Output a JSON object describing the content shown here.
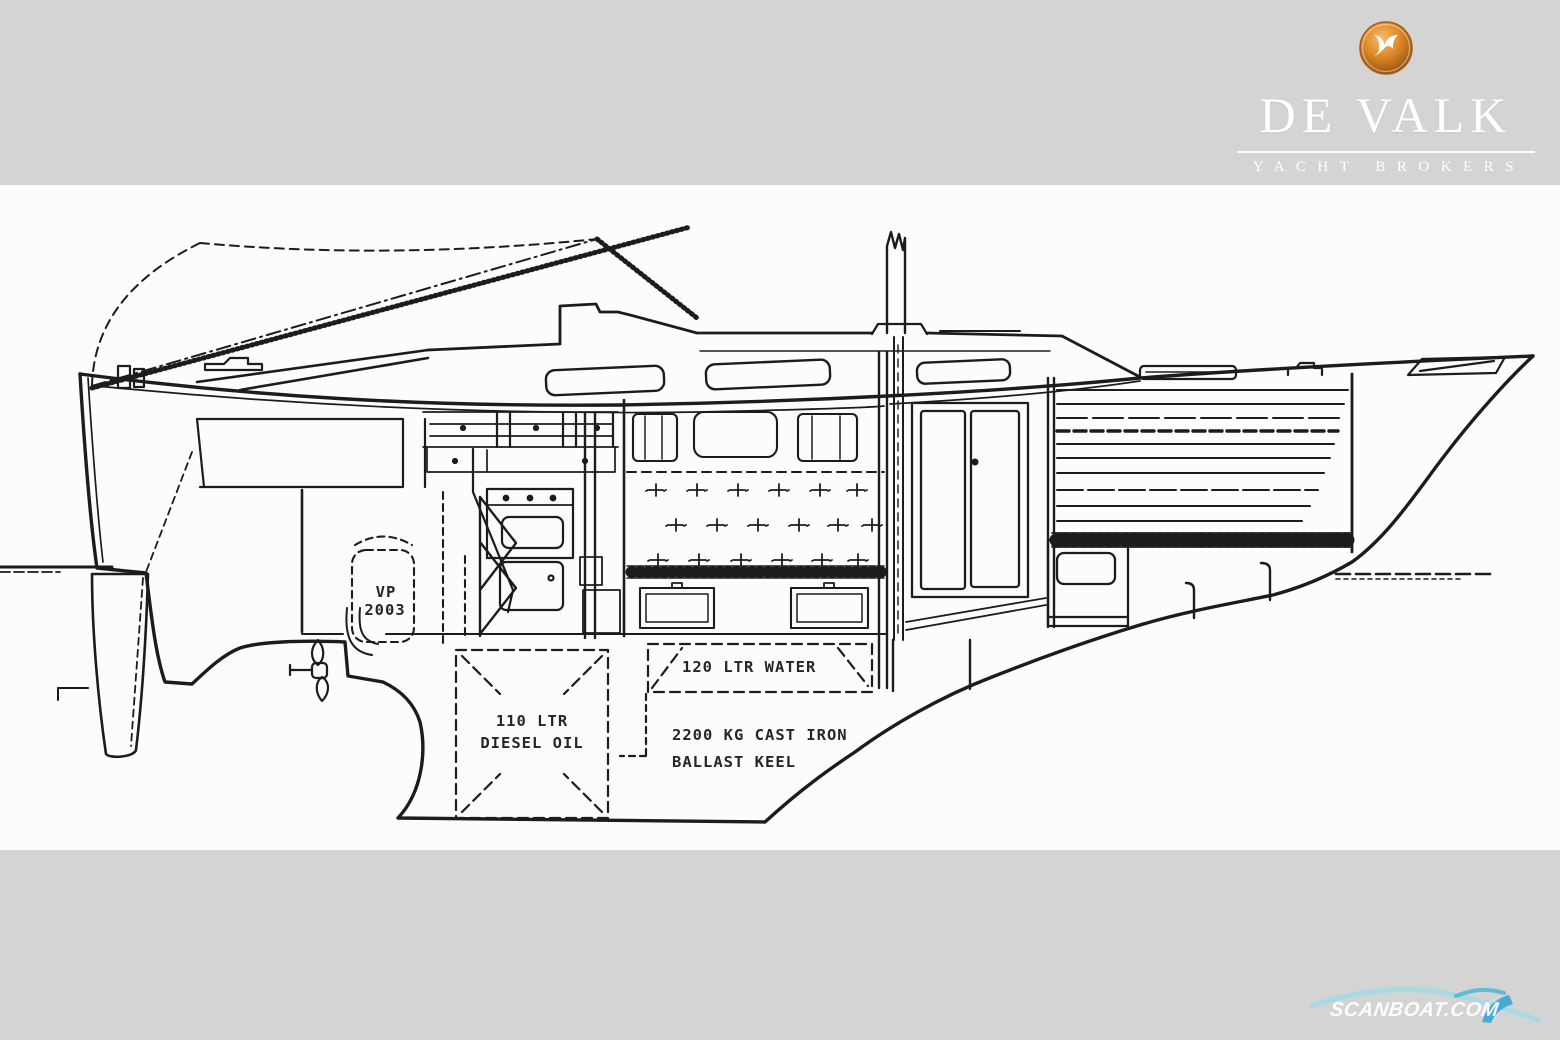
{
  "header": {
    "brand_title": "DE VALK",
    "brand_subtitle": "YACHT BROKERS"
  },
  "drawing": {
    "title_implicit": "sailing yacht profile cross-section line drawing",
    "engine_label_line1": "VP",
    "engine_label_line2": "2003",
    "diesel_tank_line1": "110 LTR",
    "diesel_tank_line2": "DIESEL OIL",
    "water_tank_label": "120 LTR WATER",
    "ballast_line1": "2200 KG CAST IRON",
    "ballast_line2": "BALLAST KEEL"
  },
  "footer": {
    "watermark": "SCANBOAT.COM"
  },
  "icons": {
    "falcon_logo": "falcon-icon",
    "wave_swoosh": "wave-icon"
  },
  "colors": {
    "band_gray": "#d4d4d4",
    "canvas_white": "#fcfcfc",
    "ink": "#1c1c1c",
    "logo_orange_light": "#f2a94e",
    "logo_orange_dark": "#9a4c0c",
    "brand_white": "#ffffff",
    "watermark_cyan": "#8fd6ea",
    "watermark_blue": "#3aa4d8"
  }
}
